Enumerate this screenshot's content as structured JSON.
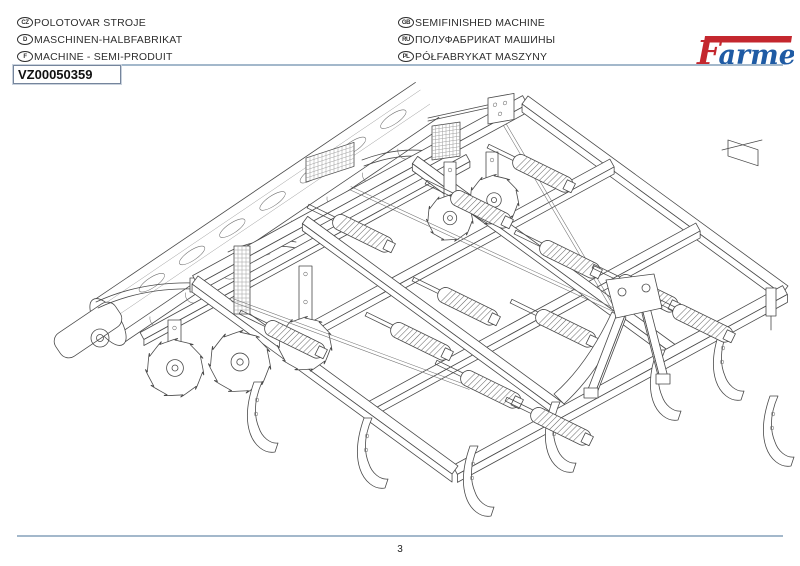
{
  "header": {
    "languages_left": [
      {
        "code": "CZ",
        "label": "POLOTOVAR STROJE"
      },
      {
        "code": "D",
        "label": "MASCHINEN-HALBFABRIKAT"
      },
      {
        "code": "F",
        "label": "MACHINE - SEMI-PRODUIT"
      }
    ],
    "languages_right": [
      {
        "code": "GB",
        "label": "SEMIFINISHED MACHINE"
      },
      {
        "code": "RU",
        "label": "ПОЛУФАБРИКАТ МАШИНЫ"
      },
      {
        "code": "PL",
        "label": "PÓŁFABRYKAT MASZYNY"
      }
    ],
    "part_number": "VZ00050359"
  },
  "logo": {
    "text": "Farmet",
    "f": "F",
    "rest": "armet"
  },
  "footer": {
    "page_number": "3"
  },
  "colors": {
    "logo_red": "#c4272e",
    "logo_blue": "#1f5ba4",
    "rule_blue": "#a3b8cb",
    "line_art": "#4a4a4a"
  }
}
